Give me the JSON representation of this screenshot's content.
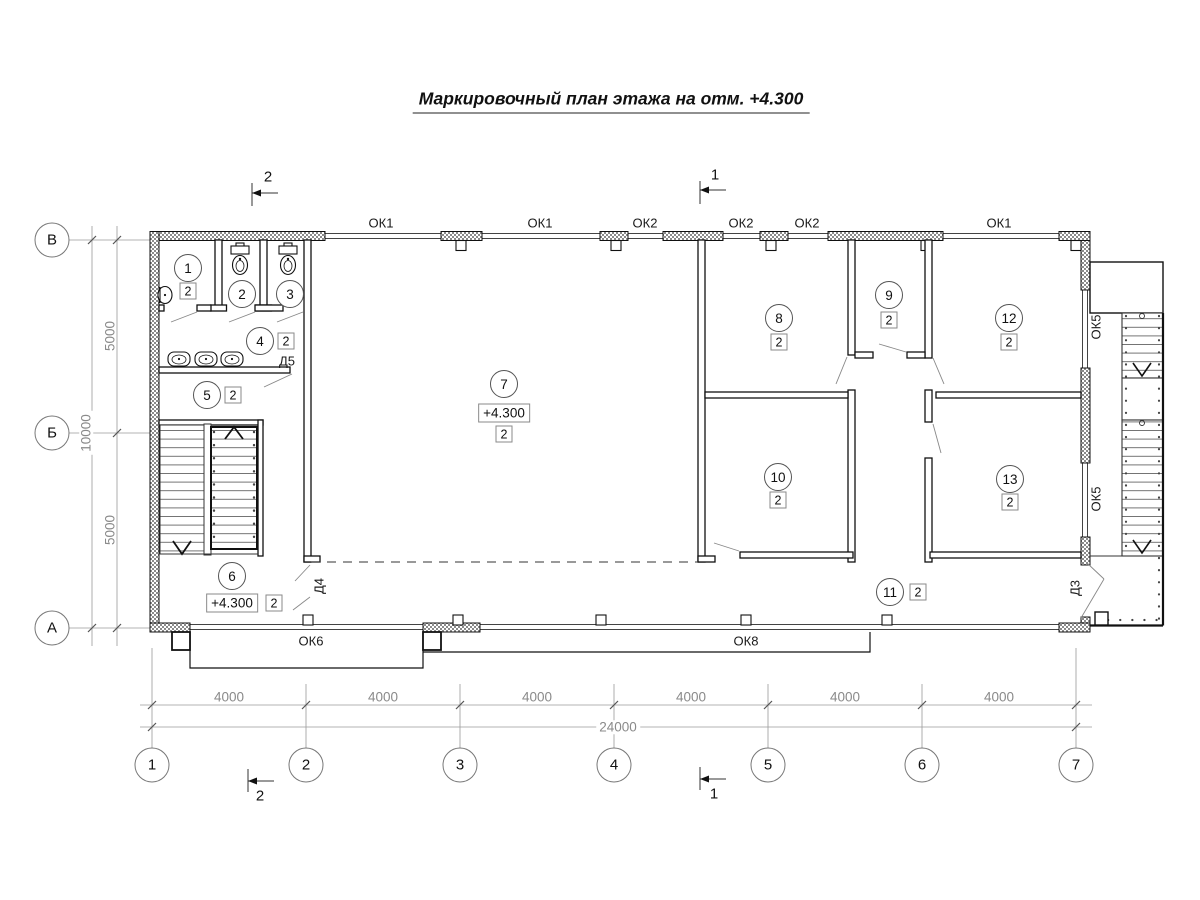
{
  "title": "Маркировочный план этажа на отм. +4.300",
  "axes": {
    "vertical": [
      "В",
      "Б",
      "А"
    ],
    "horizontal": [
      "1",
      "2",
      "3",
      "4",
      "5",
      "6",
      "7"
    ]
  },
  "dimensions": {
    "left_spans": [
      "5000",
      "5000"
    ],
    "left_total": "10000",
    "bottom_spans": [
      "4000",
      "4000",
      "4000",
      "4000",
      "4000",
      "4000"
    ],
    "bottom_total": "24000"
  },
  "sections": {
    "cut1": "1",
    "cut2": "2"
  },
  "windows": {
    "top": [
      "ОК1",
      "ОК1",
      "ОК2",
      "ОК2",
      "ОК2",
      "ОК1"
    ],
    "right": [
      "ОК5",
      "ОК5"
    ],
    "bottom": [
      "ОК6",
      "ОК8"
    ]
  },
  "doors": {
    "d5": "Д5",
    "d4": "Д4",
    "d3": "Д3"
  },
  "rooms": [
    {
      "num": "1",
      "type": "2"
    },
    {
      "num": "2"
    },
    {
      "num": "3"
    },
    {
      "num": "4",
      "type": "2"
    },
    {
      "num": "5",
      "type": "2"
    },
    {
      "num": "6",
      "type": "2",
      "elev": "+4.300"
    },
    {
      "num": "7",
      "type": "2",
      "elev": "+4.300"
    },
    {
      "num": "8",
      "type": "2"
    },
    {
      "num": "9",
      "type": "2"
    },
    {
      "num": "10",
      "type": "2"
    },
    {
      "num": "11",
      "type": "2"
    },
    {
      "num": "12",
      "type": "2"
    },
    {
      "num": "13",
      "type": "2"
    }
  ]
}
